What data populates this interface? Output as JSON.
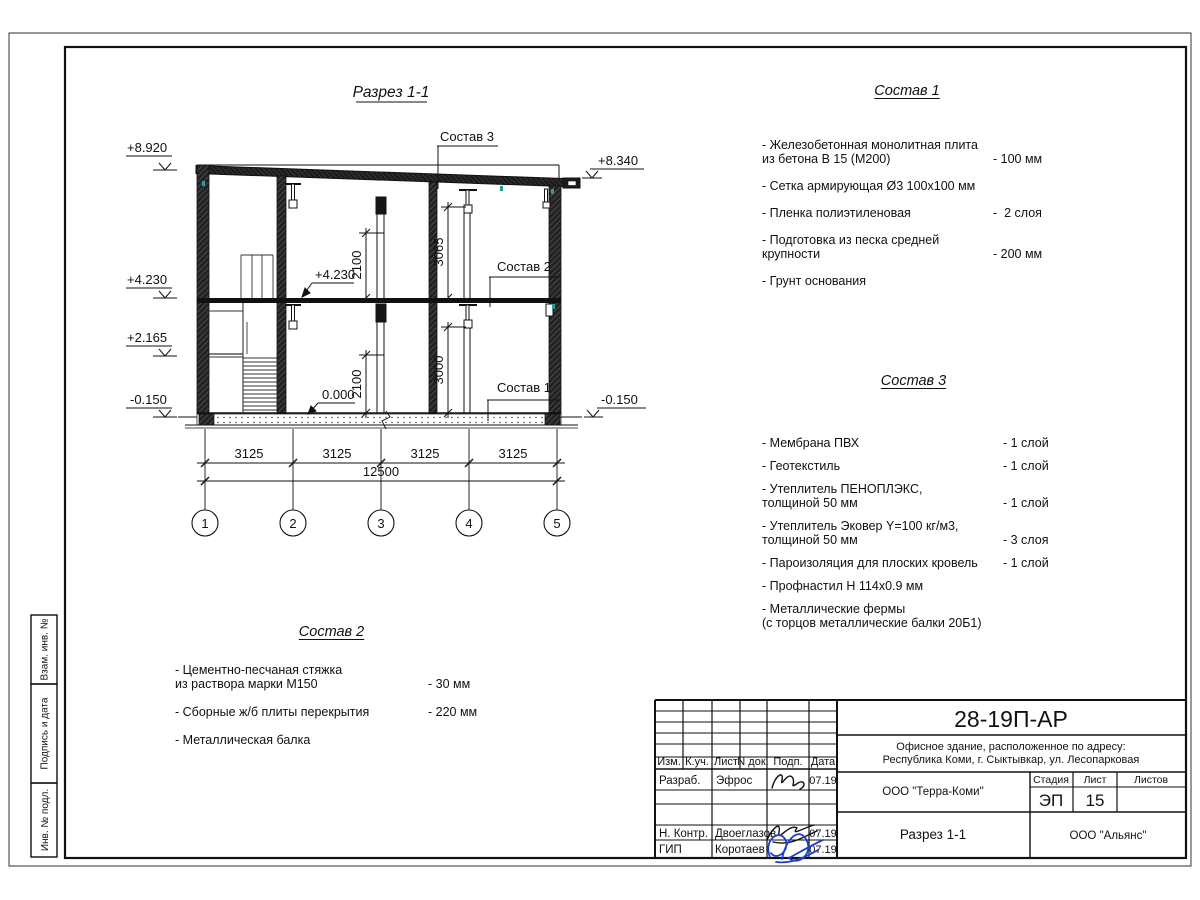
{
  "drawing": {
    "title": "Разрез 1-1",
    "axes": [
      "1",
      "2",
      "3",
      "4",
      "5"
    ],
    "dim_3125": "3125",
    "dim_12500": "12500",
    "dim_2100": "2100",
    "dim_3065": "3065",
    "dim_3000": "3000",
    "lev_8920": "+8.920",
    "lev_4230": "+4.230",
    "lev_2165": "+2.165",
    "lev_m0150": "-0.150",
    "lev_8340": "+8.340",
    "ann_4230": "+4.230",
    "ann_0000": "0.000",
    "callout_1": "Состав 1",
    "callout_2": "Состав 2",
    "callout_3": "Состав 3"
  },
  "compositions": [
    {
      "title": "Состав 1",
      "items": [
        {
          "name": "- Железобетонная  монолитная плита\n  из бетона В 15 (М200)",
          "value": "- 100 мм"
        },
        {
          "name": "- Сетка армирующая Ø3 100х100 мм",
          "value": ""
        },
        {
          "name": "- Пленка полиэтиленовая",
          "value": "-  2 слоя"
        },
        {
          "name": "- Подготовка из песка средней\n  крупности",
          "value": "- 200 мм"
        },
        {
          "name": "- Грунт основания",
          "value": ""
        }
      ]
    },
    {
      "title": "Состав 2",
      "items": [
        {
          "name": "- Цементно-песчаная стяжка\n  из раствора марки М150",
          "value": "- 30 мм"
        },
        {
          "name": "- Сборные ж/б плиты перекрытия",
          "value": "- 220 мм"
        },
        {
          "name": "- Металлическая балка",
          "value": ""
        }
      ]
    },
    {
      "title": "Состав 3",
      "items": [
        {
          "name": "- Мембрана ПВХ",
          "value": "- 1 слой"
        },
        {
          "name": "- Геотекстиль",
          "value": "- 1 слой"
        },
        {
          "name": "- Утеплитель ПЕНОПЛЭКС,\n  толщиной 50 мм",
          "value": "- 1 слой"
        },
        {
          "name": "- Утеплитель Эковер Y=100 кг/м3,\n  толщиной 50 мм",
          "value": "- 3 слоя"
        },
        {
          "name": "- Пароизоляция для плоских кровель",
          "value": "- 1 слой"
        },
        {
          "name": "- Профнастил Н 114х0.9 мм",
          "value": ""
        },
        {
          "name": "- Металлические фермы\n  (с торцов металлические балки 20Б1)",
          "value": ""
        }
      ]
    }
  ],
  "titleblock": {
    "code": "28-19П-АР",
    "object_line1": "Офисное здание, расположенное по адресу:",
    "object_line2": "Республика Коми, г. Сыктывкар, ул. Лесопарковая",
    "col_izm": "Изм.",
    "col_kuch": "К.уч.",
    "col_list": "Лист",
    "col_ndok": "N док.",
    "col_podp": "Подп.",
    "col_data": "Дата",
    "row1_role": "Разраб.",
    "row1_name": "Эфрос",
    "row1_date": "07.19",
    "row2_role": "Н. Контр.",
    "row2_name": "Двоеглазов",
    "row2_date": "07.19",
    "row3_role": "ГИП",
    "row3_name": "Коротаев",
    "row3_date": "07.19",
    "org_design": "ООО \"Терра-Коми\"",
    "stage_label": "Стадия",
    "sheet_label": "Лист",
    "sheets_label": "Листов",
    "stage": "ЭП",
    "sheet_no": "15",
    "sheet_title": "Разрез 1-1",
    "org_customer": "ООО \"Альянс\""
  },
  "margin_labels": [
    "Взам. инв. №",
    "Подпись и дата",
    "Инв. № подл."
  ]
}
